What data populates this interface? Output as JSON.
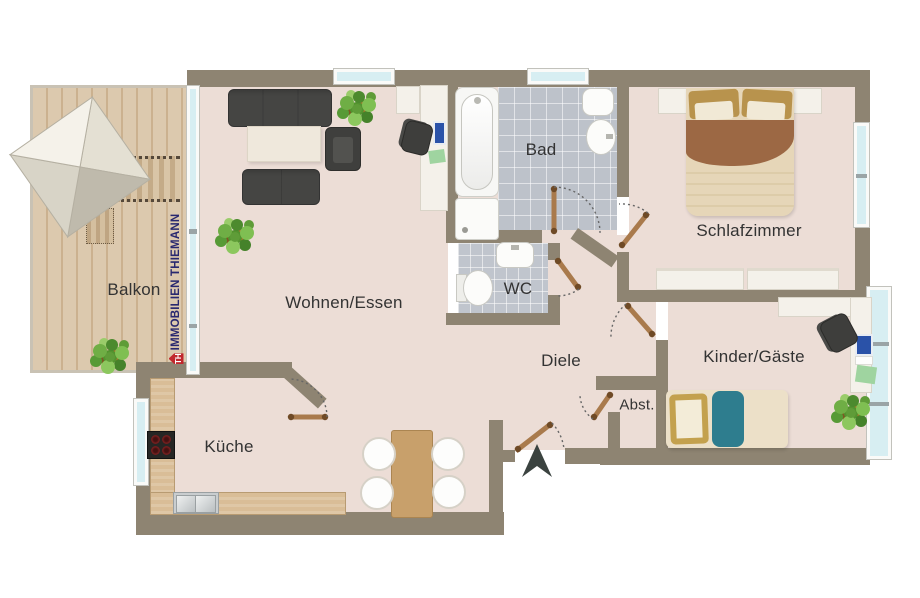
{
  "rooms": {
    "balkon": {
      "label": "Balkon"
    },
    "wohnen_essen": {
      "label": "Wohnen/Essen"
    },
    "kueche": {
      "label": "Küche"
    },
    "bad": {
      "label": "Bad"
    },
    "wc": {
      "label": "WC"
    },
    "diele": {
      "label": "Diele"
    },
    "schlafzimmer": {
      "label": "Schlafzimmer"
    },
    "kinder_gaeste": {
      "label": "Kinder/Gäste"
    },
    "abstellraum": {
      "label": "Abst."
    }
  },
  "watermark": {
    "logo": "TH",
    "name": "IMMOBILIEN THIEMANN"
  },
  "colors": {
    "wall": "#8e8472",
    "floor": "#ecddd6",
    "tile": "#bdc2ca",
    "balcony_wood": "#dcc9ae",
    "counter_wood": "#d9bd97",
    "glass": "#d7eef2",
    "furniture_dark": "#454543",
    "bed_blanket_brown": "#9c6844",
    "bed_teal": "#2e7d8e",
    "logo_blue": "#28286f",
    "logo_red": "#c1272d"
  },
  "icons": {
    "entrance_arrow": "solid dark chevron pointing into entrance",
    "door": "brown leaf with dotted swing arc",
    "plant": "green leaf cluster",
    "parasol": "square canopy, top-left of balcony"
  }
}
